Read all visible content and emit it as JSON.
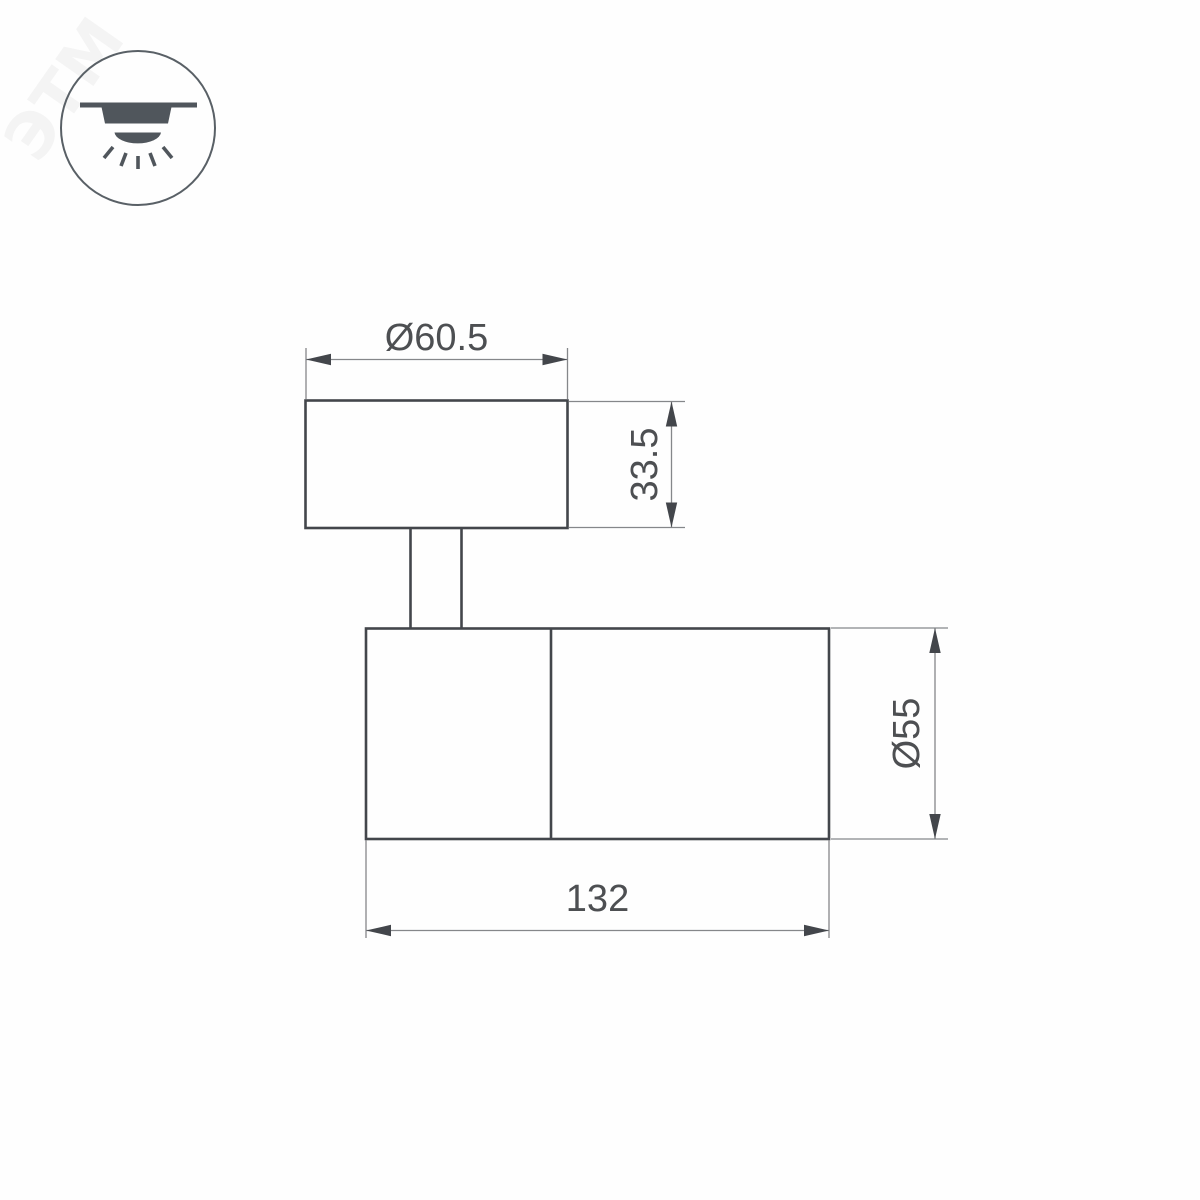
{
  "drawing": {
    "type": "technical-dimension-drawing",
    "subject": "surface-mounted spot light, side view",
    "watermark": "ЭТМ",
    "icon": {
      "name": "surface-mount-downlight-icon",
      "meaning": "ceiling surface-mounted luminaire with downward light"
    },
    "dimensions": {
      "mount_diameter": "Ø60.5",
      "mount_height": "33.5",
      "body_diameter": "Ø55",
      "body_length": "132"
    },
    "colors": {
      "outline": "#43464b",
      "dimline": "#85878a",
      "dimtext": "#4d4f52",
      "icon": "#50565c",
      "iconring": "#596066",
      "background": "#fefefe"
    }
  }
}
